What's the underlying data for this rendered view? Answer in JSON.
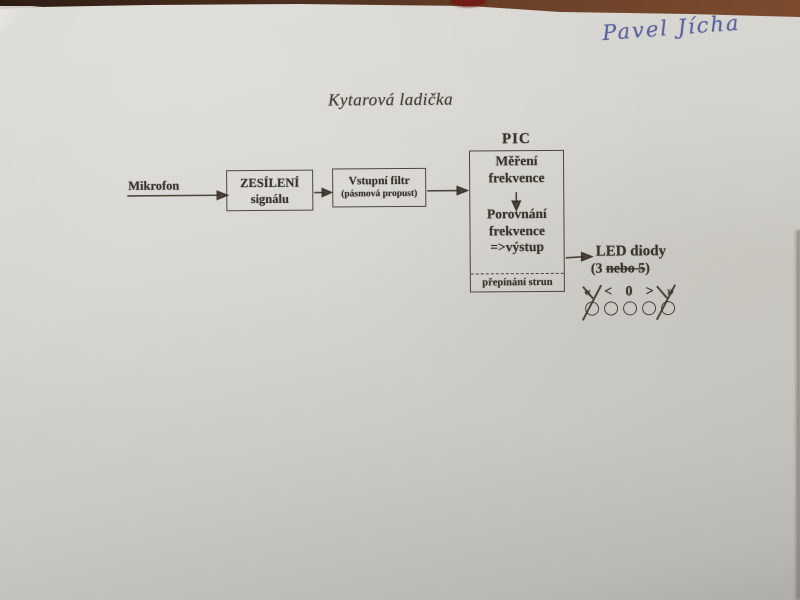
{
  "photo": {
    "handwritten_name": "Pavel Jícha",
    "title": "Kytarová ladička"
  },
  "diagram": {
    "mic_label": "Mikrofon",
    "amp_box": {
      "line1": "ZESÍLENÍ",
      "line2": "signálu"
    },
    "filter_box": {
      "line1": "Vstupní filtr",
      "line2": "(pásmová propust)"
    },
    "pic": {
      "label": "PIC",
      "step1_line1": "Měření",
      "step1_line2": "frekvence",
      "step2_line1": "Porovnání",
      "step2_line2": "frekvence",
      "step2_line3": "=>výstup",
      "footer": "přepínání strun"
    },
    "led": {
      "title": "LED diody",
      "count_prefix": "(3 ",
      "count_struck": "nebo 5",
      "count_suffix": ")",
      "symbols": [
        "«",
        "<",
        "0",
        ">",
        "»"
      ],
      "led_count": 5,
      "crossed_leds": "first and last"
    }
  },
  "colors": {
    "paper": "#d4d3ce",
    "ink": "#3a332d",
    "handwriting_ink": "#4e589b",
    "table_edge": "#6b4129"
  }
}
